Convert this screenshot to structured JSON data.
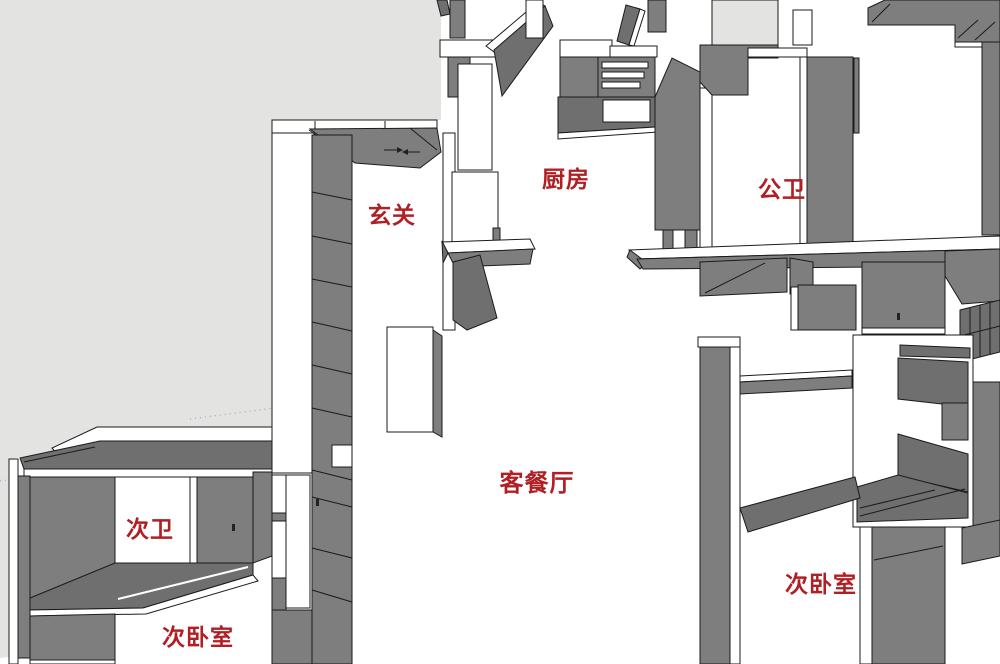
{
  "title": "3D户型图",
  "colors": {
    "wall_gray": "#7e7e7e",
    "wall_dark": "#6f6f6f",
    "exterior_gray": "#e3e3e1",
    "outline": "#1b1b1b",
    "floor_white": "#ffffff",
    "label_red": "#b01f23"
  },
  "rooms": [
    {
      "name": "玄关"
    },
    {
      "name": "厨房"
    },
    {
      "name": "公卫"
    },
    {
      "name": "客餐厅"
    },
    {
      "name": "次卫"
    },
    {
      "name": "次卧室"
    },
    {
      "name": "次卧室"
    }
  ]
}
